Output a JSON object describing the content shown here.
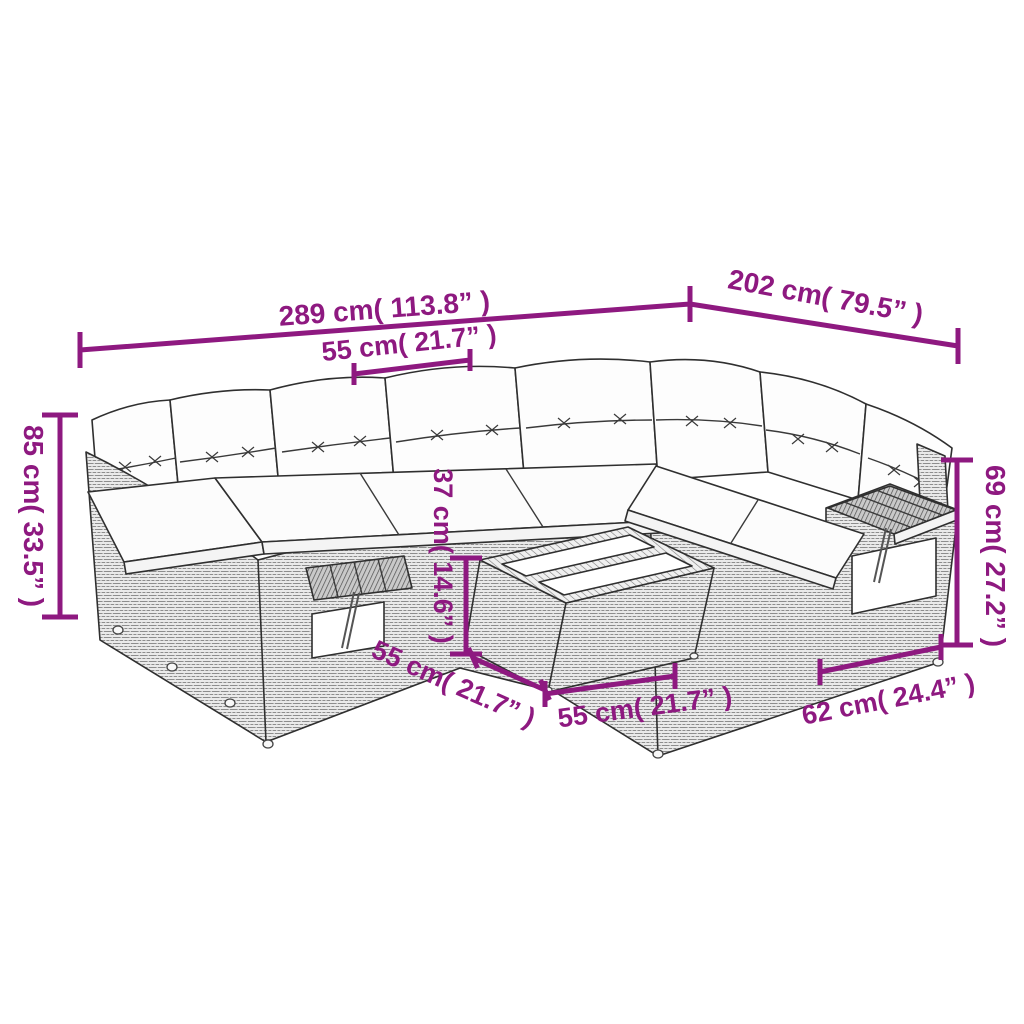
{
  "diagram": {
    "type": "product-dimension-diagram",
    "subject": "rattan garden sofa set with cushions and coffee table",
    "background_color": "#ffffff",
    "accent_color": "#8e1980",
    "line_art_color": "#2f2f2f",
    "labels": {
      "overall_width": "289 cm( 113.8” )",
      "overall_depth": "202 cm( 79.5” )",
      "seat_width_top": "55 cm( 21.7” )",
      "overall_height": "85 cm( 33.5” )",
      "table_height": "37 cm( 14.6” )",
      "seat_depth_diag": "55 cm( 21.7” )",
      "table_width": "55 cm( 21.7” )",
      "armrest_section_width": "62 cm( 24.4” )",
      "backrest_height": "69 cm( 27.2” )"
    }
  }
}
